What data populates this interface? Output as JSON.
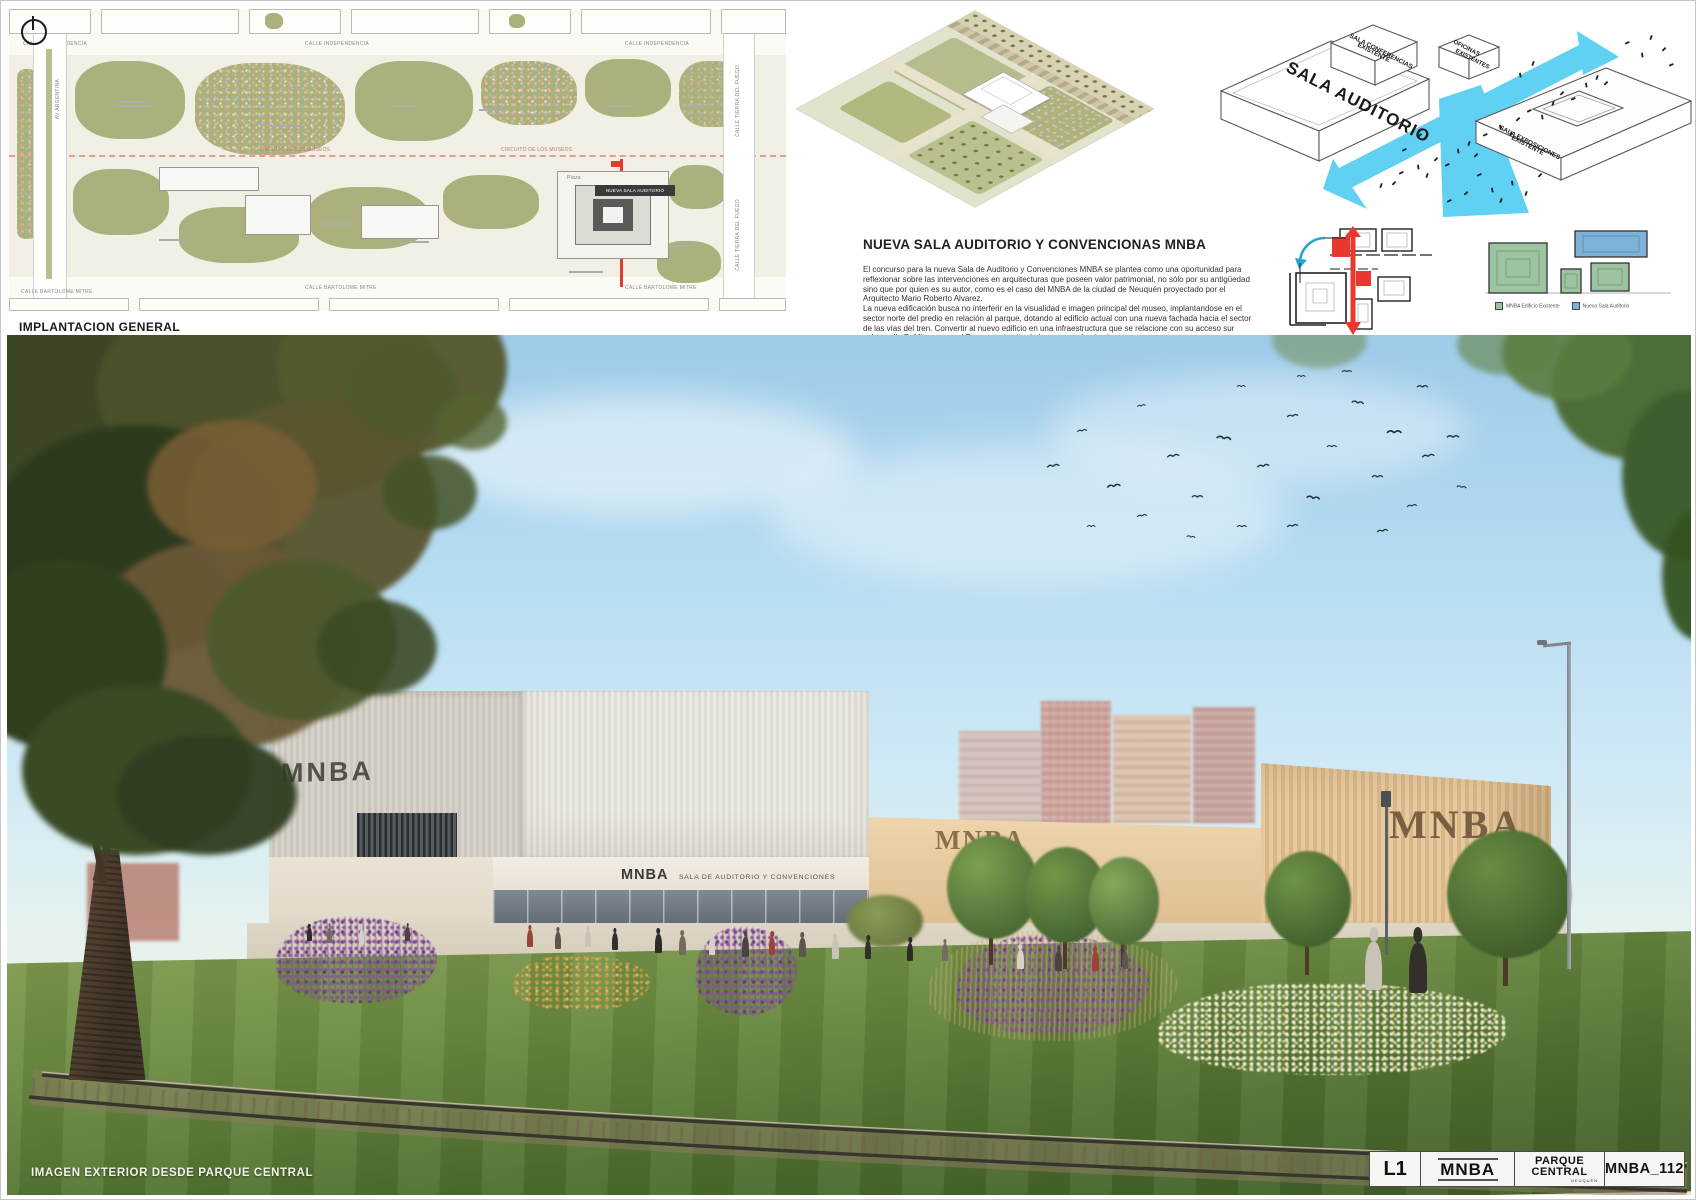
{
  "site_plan": {
    "title": "IMPLANTACION GENERAL",
    "scale": "ESC. 1:300",
    "street_top_1": "CALLE INDEPENDENCIA",
    "street_top_2": "CALLE INDEPENDENCIA",
    "street_top_3": "CALLE INDEPENDENCIA",
    "street_bottom_1": "CALLE BARTOLOME MITRE",
    "street_bottom_2": "CALLE BARTOLOME MITRE",
    "street_bottom_3": "CALLE BARTOLOME MITRE",
    "street_left": "AV ARGENTINA",
    "street_right_1": "CALLE TIERRA DEL FUEGO",
    "street_right_2": "CALLE TIERRA DEL FUEGO",
    "label_new_building": "NUEVA SALA AUDITORIO",
    "label_circuit_1": "CIRCUITO DE LOS MUSEOS",
    "label_circuit_2": "CIRCUITO DE LOS MUSEOS",
    "label_plaza": "Plaza"
  },
  "description": {
    "title": "NUEVA SALA AUDITORIO Y CONVENCIONAS MNBA",
    "paragraphs": [
      "El concurso para la nueva Sala de Auditorio y Convenciones MNBA se plantea como una oportunidad para reflexionar sobre las intervenciones en arquitecturas que poseen valor patrimonial, no sólo por su antigüedad sino que por quien es su autor, como es el caso del MNBA de la ciudad de Neuquén proyectado por el Arquitecto Mario Roberto Alvarez.",
      "La nueva edificación busca no interferir en la visualidad e imagen principal del museo, implantandose en el sector norte del predio en relación al parque, dotando al edificio actual con una nueva fachada hacia el sector de las vías del tren. Convertir al nuevo edificio en una infraestructura que se relacione con su acceso sur sobre calle B. Mitre, y con el Parque y circuito de los museos hacia el norte.",
      "La intervención se plantea como una construcción contemporánea contenedora de espacios de relación, salas y foyers, de manera que el vínculo entre lo construido y la nueva arquitectura permite resaltar valores de ambas.",
      "No intenta mimetizarse, sino que trabaja el contraste y la abstracción como herramientas formales para el nuevo vínculo."
    ]
  },
  "iso": {
    "label_auditorio": "SALA AUDITORIO",
    "label_conferencias_1": "SALA CONFERENCIAS",
    "label_conferencias_2": "EXISTENTE",
    "label_oficinas_1": "OFICINAS",
    "label_oficinas_2": "EXISTENTES",
    "label_exposiciones_1": "SALA EXPOSICIONES",
    "label_exposiciones_2": "EXISTENTE"
  },
  "diagrams": {
    "vinculos_title": "VÍNCULOS URBANOS",
    "formales_title": "RELACIONES FORMALES",
    "legend_existente": "MNBA Edificio Existente",
    "legend_nueva": "Nueva Sala Auditorio"
  },
  "render": {
    "caption": "IMAGEN EXTERIOR DESDE PARQUE CENTRAL",
    "sign_box": "MNBA",
    "sign_entrance_main": "MNBA",
    "sign_entrance_sub": "SALA DE AUDITORIO Y CONVENCIONES",
    "sign_wall_mid": "MNBA",
    "sign_wall_right": "MNBA"
  },
  "titleblock": {
    "sheet": "L1",
    "mnba": "MNBA",
    "parque_1": "PARQUE",
    "parque_2": "CENTRAL",
    "parque_sub": "NEUQUÉN",
    "code": "MNBA_112"
  },
  "colors": {
    "accent_cyan": "#45C8F1",
    "accent_red": "#E8392E",
    "legend_green": "#9CC4A0",
    "legend_blue": "#7FB2D8",
    "wall_beige": "#E2C69C",
    "sky": "#A9D3EC",
    "lawn": "#5E7D3A"
  }
}
